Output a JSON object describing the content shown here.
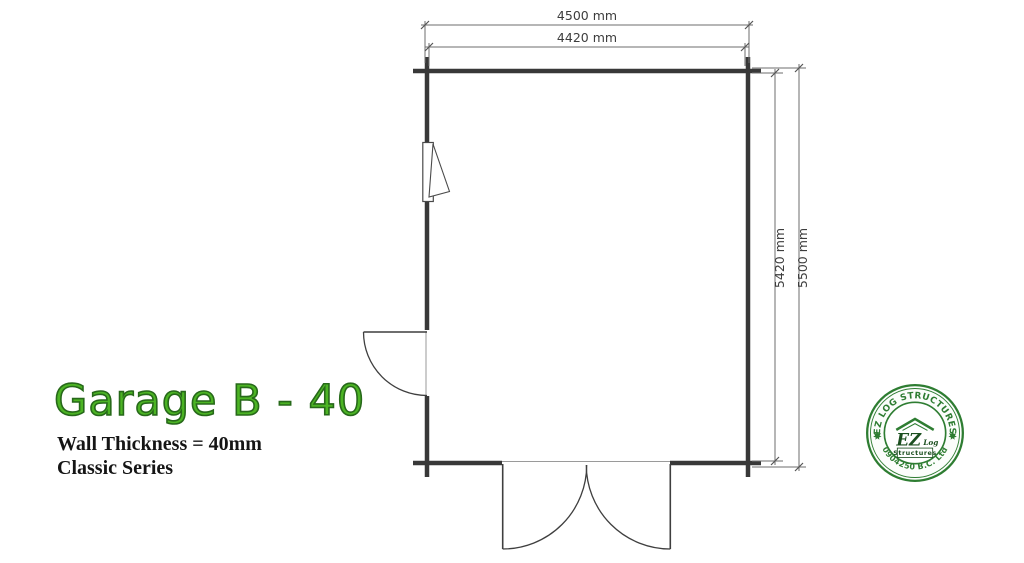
{
  "title": {
    "text": "Garage B - 40",
    "color": "#4cb424",
    "outline_color": "#27691a"
  },
  "subtitle": {
    "line1": "Wall Thickness = 40mm",
    "line2": "Classic Series"
  },
  "plan": {
    "dim_outer_width": "4500 mm",
    "dim_inner_width": "4420 mm",
    "dim_inner_height": "5420 mm",
    "dim_outer_height": "5500 mm",
    "wall_color": "#383838",
    "dim_line_color": "#6e6e6e"
  },
  "stamp": {
    "arc_top": "EZ LOG STRUCTURES",
    "arc_bottom": "0904250 B.C. Ltd",
    "logo_ez": "EZ",
    "logo_log": "Log",
    "logo_structures": "Structures",
    "color": "#2e7d32"
  }
}
